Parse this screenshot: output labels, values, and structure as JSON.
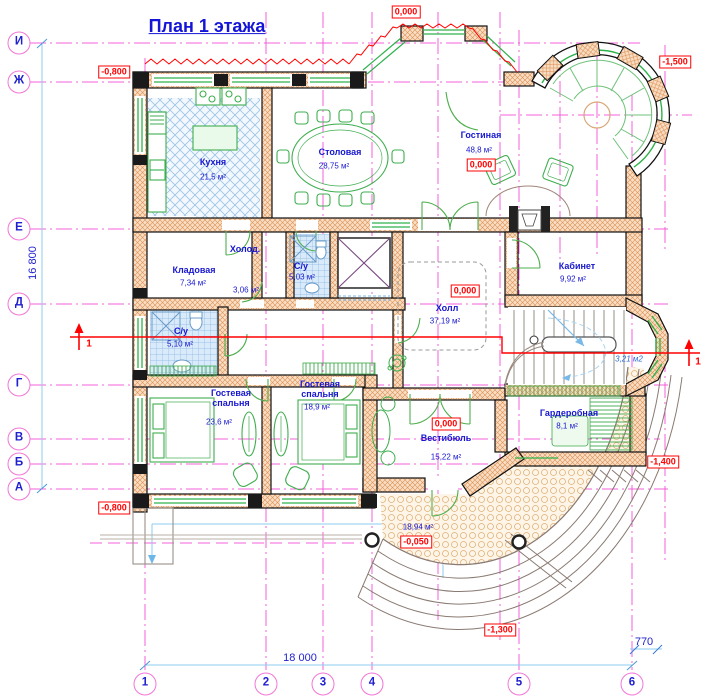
{
  "title": "План 1 этажа",
  "grid": {
    "rows": [
      {
        "label": "И"
      },
      {
        "label": "Ж"
      },
      {
        "label": "Е"
      },
      {
        "label": "Д"
      },
      {
        "label": "Г"
      },
      {
        "label": "В"
      },
      {
        "label": "Б"
      },
      {
        "label": "А"
      }
    ],
    "cols": [
      {
        "label": "1"
      },
      {
        "label": "2"
      },
      {
        "label": "3"
      },
      {
        "label": "4"
      },
      {
        "label": "5"
      },
      {
        "label": "6"
      }
    ]
  },
  "dimensions": {
    "total_height": "16 800",
    "total_width": "18 000",
    "right_offset": "770"
  },
  "rooms": [
    {
      "name": "Кухня",
      "area": "21,5 м²"
    },
    {
      "name": "Столовая",
      "area": "28,75 м²"
    },
    {
      "name": "Гостиная",
      "area": "48,8 м²"
    },
    {
      "name": "Кладовая",
      "area": "7,34 м²"
    },
    {
      "name": "Холод.",
      "area": "3,06 м²"
    },
    {
      "name": "С/у",
      "area": "5,03 м²"
    },
    {
      "name": "С/у",
      "area": "5,10 м²"
    },
    {
      "name": "Кабинет",
      "area": "9,92 м²"
    },
    {
      "name": "Холл",
      "area": "37,19 м²"
    },
    {
      "name": "Гостевая спальня",
      "area": "23,6 м²"
    },
    {
      "name": "Гостевая спальня",
      "area": "18,9 м²"
    },
    {
      "name": "Вестибюль",
      "area": "15,22 м²"
    },
    {
      "name": "Гардеробная",
      "area": "8,1 м²"
    },
    {
      "name": "",
      "area": "18,94 м²"
    },
    {
      "name": "",
      "area": "3,21 м2"
    }
  ],
  "elevations": [
    {
      "value": "0,000"
    },
    {
      "value": "-0,800"
    },
    {
      "value": "-1,500"
    },
    {
      "value": "0,000"
    },
    {
      "value": "0,000"
    },
    {
      "value": "0,000"
    },
    {
      "value": "-0,050"
    },
    {
      "value": "-1,400"
    },
    {
      "value": "-1,300"
    },
    {
      "value": "-0,800"
    }
  ],
  "section": {
    "mark": "1"
  },
  "colors": {
    "grid": "#f460d8",
    "text_blue": "#1717cf",
    "alert_red": "#ff0000",
    "wall_hatch": "#dd9055",
    "furniture_green": "#3fae4f",
    "tile_blue": "#8ab6de",
    "dim_blue": "#8ecdf0"
  }
}
